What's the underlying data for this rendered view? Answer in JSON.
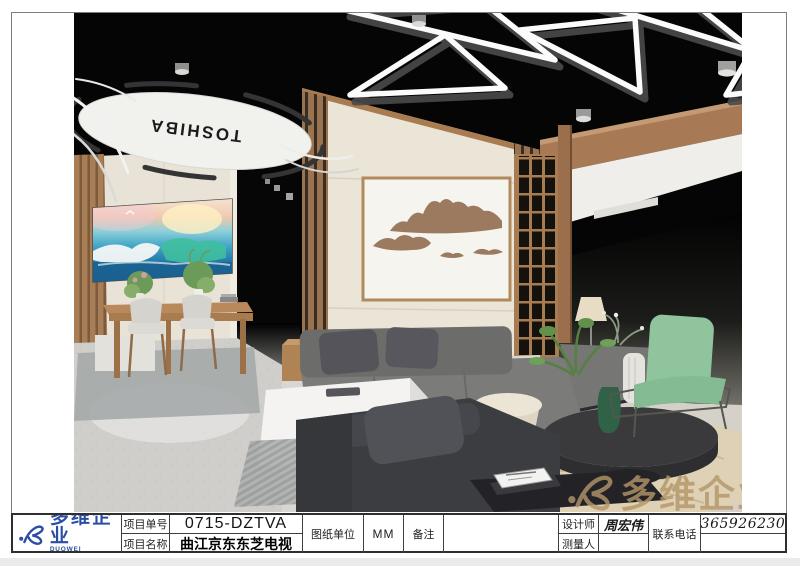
{
  "title_block": {
    "logo": {
      "name": "多维企业",
      "name_en": "DUOWEI ENTERPRISE",
      "color": "#2b4da3"
    },
    "project_no_label": "项目单号",
    "project_no_value": "0715-DZTVA",
    "project_name_label": "项目名称",
    "project_name_value": "曲江京东东芝电视",
    "unit_label": "图纸单位",
    "unit_value": "MM",
    "remark_label": "备注",
    "remark_value": "",
    "designer_label": "设计师",
    "designer_value": "周宏伟",
    "surveyor_label": "测量人",
    "surveyor_value": "",
    "phone_label": "联系电话",
    "phone_value": "13659262305"
  },
  "render": {
    "brand_sign_text": "TOSHIBA",
    "watermark_text": "多维企业",
    "watermark_color": "#b49668",
    "colors": {
      "ceiling": "#050505",
      "wood": "#a87c52",
      "cream_wall": "#e9e3d7",
      "art_panel": "#f6f4ee",
      "mountain_relief": "#9b7a5f",
      "sofa_gray": "#7b7b79",
      "sofa_dark": "#3c3d41",
      "accent_green_chair": "#8fc49c",
      "rug_tan": "#ded1b5",
      "floor": "#d5d3cf"
    }
  }
}
